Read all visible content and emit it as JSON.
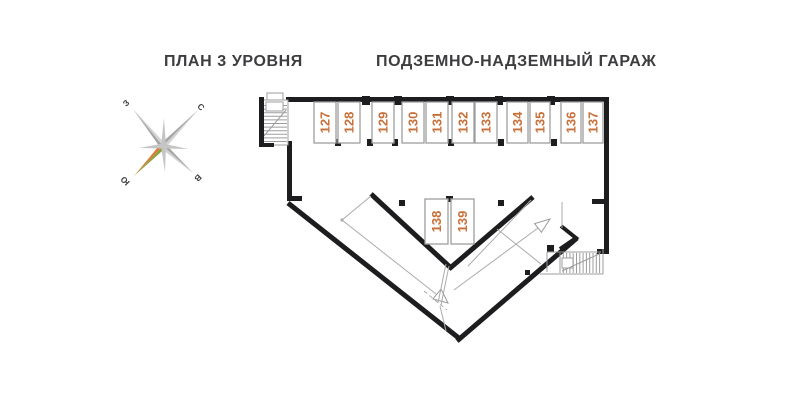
{
  "header": {
    "plan_title": "ПЛАН 3 УРОВНЯ",
    "building_title": "ПОДЗЕМНО-НАДЗЕМНЫЙ ГАРАЖ"
  },
  "compass": {
    "west_label": "З",
    "north_label": "С",
    "south_label": "Ю",
    "east_label": "В"
  },
  "plan": {
    "stalls": [
      {
        "label": "127"
      },
      {
        "label": "128"
      },
      {
        "label": "129"
      },
      {
        "label": "130"
      },
      {
        "label": "131"
      },
      {
        "label": "132"
      },
      {
        "label": "133"
      },
      {
        "label": "134"
      },
      {
        "label": "135"
      },
      {
        "label": "136"
      },
      {
        "label": "137"
      },
      {
        "label": "138"
      },
      {
        "label": "139"
      }
    ]
  },
  "colors": {
    "accent_orange": "#c7703a",
    "wall_black": "#1d1d1f",
    "line_gray": "#9d9d9d",
    "text_dark": "#3d3d3f",
    "compass_needle_orange": "#dd7a37",
    "compass_needle_green": "#8aa23c"
  }
}
